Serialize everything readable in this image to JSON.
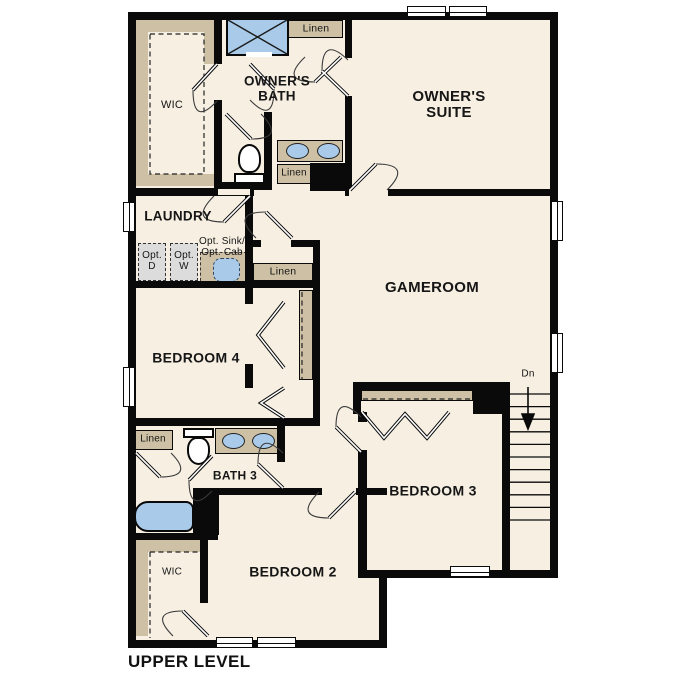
{
  "plan_title": "UPPER LEVEL",
  "rooms": {
    "wic_upper": "WIC",
    "owners_bath": "OWNER'S BATH",
    "owners_suite": "OWNER'S SUITE",
    "laundry": "LAUNDRY",
    "gameroom": "GAMEROOM",
    "bedroom4": "BEDROOM 4",
    "bath3": "BATH 3",
    "bedroom3": "BEDROOM 3",
    "bedroom2": "BEDROOM 2",
    "wic_lower": "WIC"
  },
  "closets": {
    "linen_upper": "Linen",
    "linen_vanity": "Linen",
    "linen_hall": "Linen",
    "linen_bath3": "Linen"
  },
  "annotations": {
    "opt_dryer": "Opt. D",
    "opt_washer": "Opt. W",
    "opt_sink_cab": "Opt. Sink/ Opt. Cab",
    "stairs_down": "Dn"
  },
  "colors": {
    "floor": "#f6efe2",
    "wall": "#0a0a0a",
    "accent_tan": "#cdc0a4",
    "fixture_blue": "#a9cbe9",
    "appliance_gray": "#dcdcdc"
  }
}
